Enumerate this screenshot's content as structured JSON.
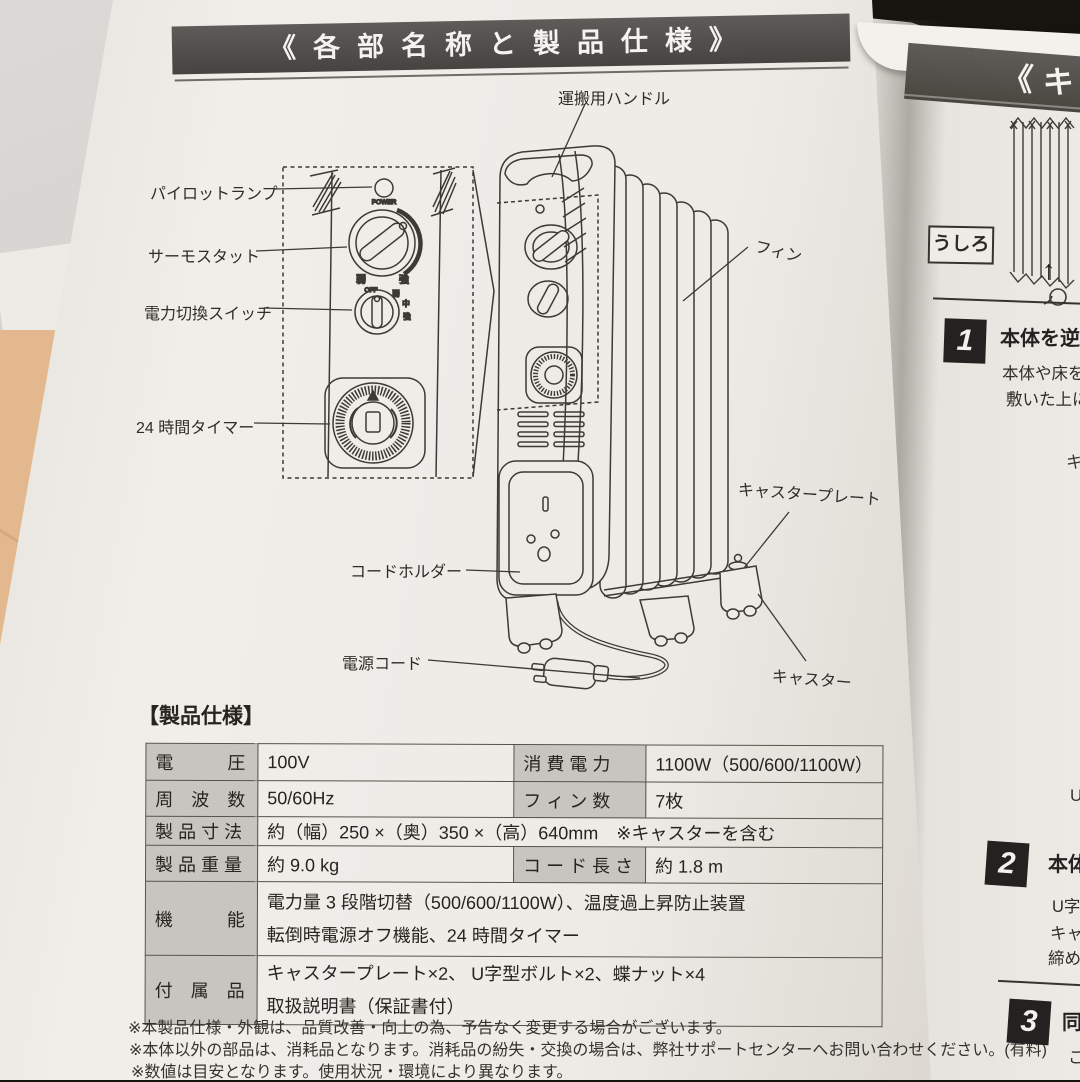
{
  "title_banner": "《各部名称と製品仕様》",
  "parts": {
    "handle": "運搬用ハンドル",
    "pilot_lamp": "パイロットランプ",
    "thermostat": "サーモスタット",
    "power_switch": "電力切換スイッチ",
    "timer": "24 時間タイマー",
    "fin": "フィン",
    "caster_plate": "キャスタープレート",
    "cord_holder": "コードホルダー",
    "power_cord": "電源コード",
    "caster": "キャスター"
  },
  "diagram_labels": {
    "power": "POWER",
    "off": "OFF",
    "low": "弱",
    "mid": "中",
    "high": "強"
  },
  "spec": {
    "heading": "【製品仕様】",
    "rows": {
      "voltage_label": "電　　　圧",
      "voltage": "100V",
      "power_label": "消 費 電 力",
      "power": "1100W（500/600/1100W）",
      "freq_label": "周　波　数",
      "freq": "50/60Hz",
      "fins_label": "フ ィ ン 数",
      "fins": "7枚",
      "dim_label": "製 品 寸 法",
      "dim": "約（幅）250 ×（奥）350 ×（高）640mm　※キャスターを含む",
      "weight_label": "製 品 重 量",
      "weight": "約 9.0 kg",
      "cordlen_label": "コ ー ド 長 さ",
      "cordlen": "約 1.8 m",
      "func_label": "機　　　能",
      "func1": "電力量 3 段階切替（500/600/1100W）、温度過上昇防止装置",
      "func2": "転倒時電源オフ機能、24 時間タイマー",
      "acc_label": "付　属　品",
      "acc1": "キャスタープレート×2、 U字型ボルト×2、蝶ナット×4",
      "acc2": "取扱説明書（保証書付）"
    }
  },
  "notes": [
    "※本製品仕様・外観は、品質改善・向上の為、予告なく変更する場合がございます。",
    "※本体以外の部品は、消耗品となります。消耗品の紛失・交換の場合は、弊社サポートセンターへお問い合わせください。(有料)",
    "※数値は目安となります。使用状況・環境により異なります。"
  ],
  "right_page": {
    "banner_partial": "《キ",
    "back_label": "うしろ",
    "up_arrow": "↑",
    "steps": [
      {
        "num": "1",
        "heading": "本体を逆さ",
        "line1": "本体や床を傷",
        "line2": "敷いた上にヒ"
      },
      {
        "num": "2",
        "heading": "本体",
        "line1": "U字",
        "line2": "キャ",
        "line3": "締め"
      },
      {
        "num": "3",
        "heading": "同",
        "line1": "こ"
      }
    ],
    "partial_chars": [
      "キ",
      "U"
    ]
  }
}
